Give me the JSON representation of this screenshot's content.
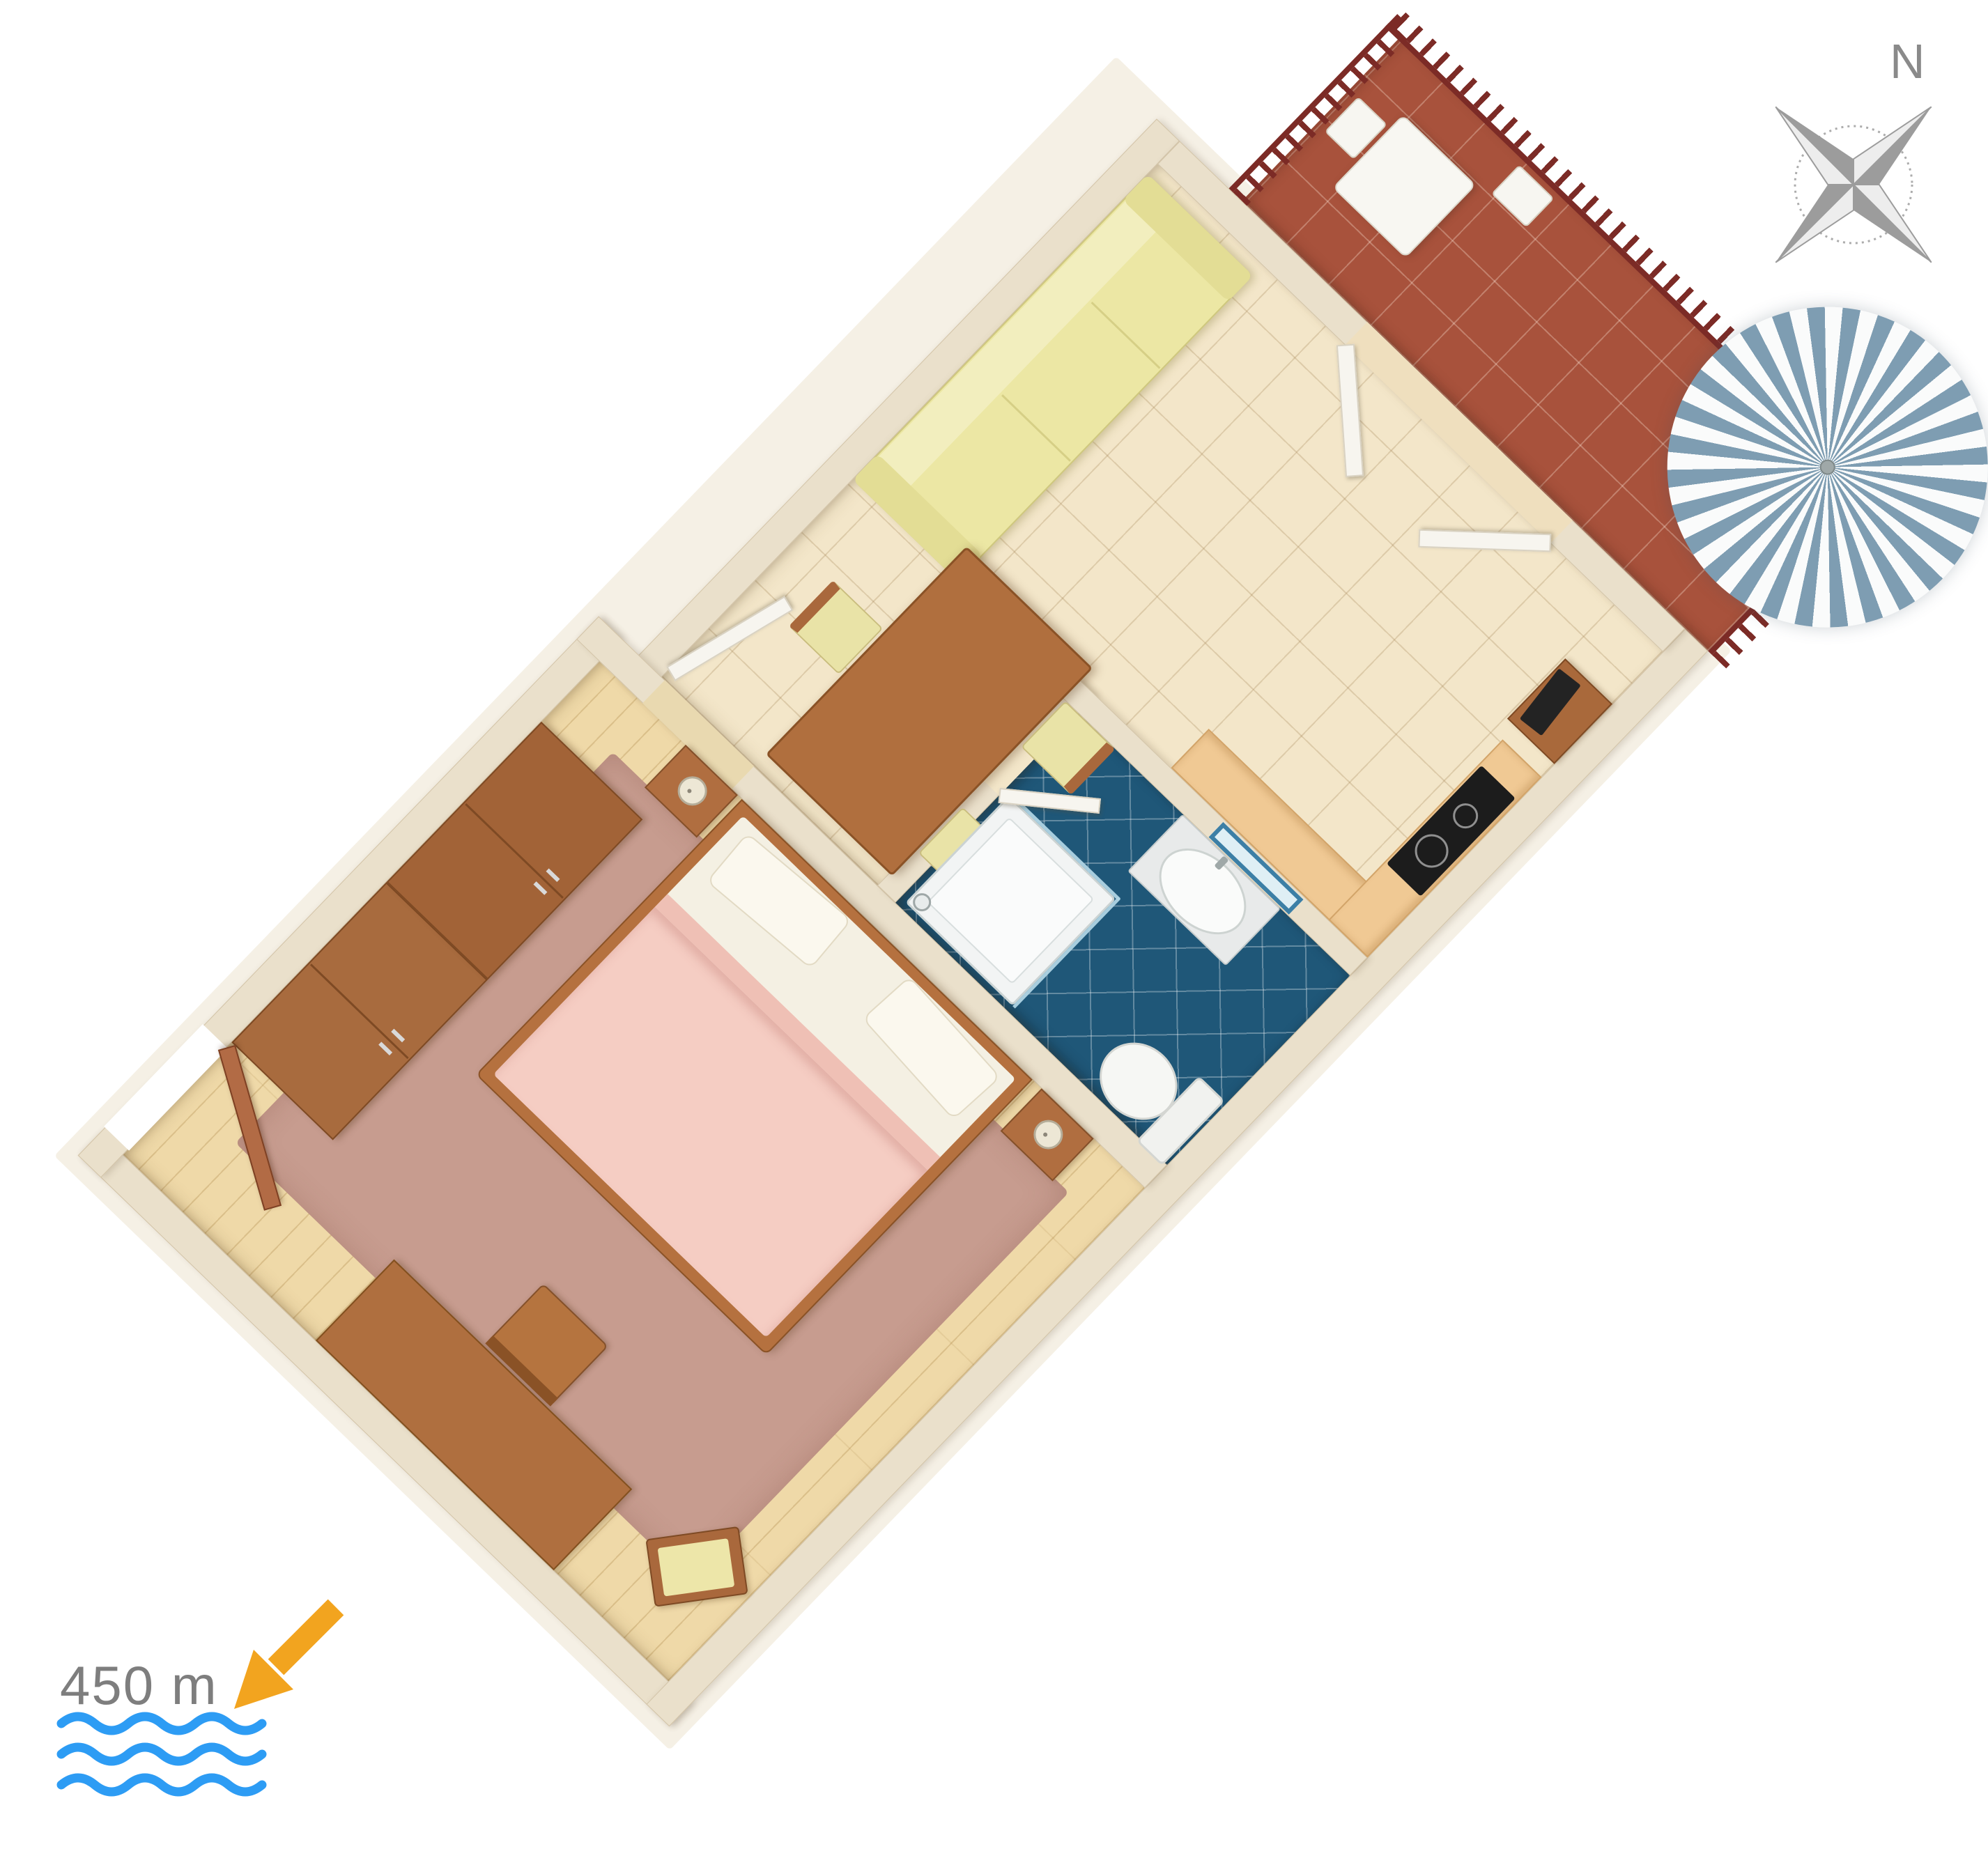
{
  "annotations": {
    "north_label": "N",
    "distance_label": "450 m"
  },
  "legend": {
    "distance_to_sea_m": 450,
    "direction_icon": "arrow-down-left",
    "sea_icon": "three-wavy-lines",
    "compass_icon": "four-point-compass-rose-rotated-45"
  },
  "colors": {
    "background": "#FFFFFF",
    "wall": "#EAE0CB",
    "bedroom_floor": "#EFD9A8",
    "bedroom_rug": "#C79C8F",
    "living_tile": "#F3E6C9",
    "bathroom_tile": "#1F5778",
    "terrace_tile": "#A8523C",
    "railing": "#7C2B26",
    "sofa": "#ECE7A4",
    "wood_furniture": "#AF6F3F",
    "bed_blanket": "#F5CDC3",
    "kitchen_counter": "#F0C994",
    "cooktop": "#1C1C1C",
    "parasol_stripe": "#7E9DB2",
    "arrow_orange": "#F2A41F",
    "waves_blue": "#2D9CF4",
    "label_gray": "#7E7E7E",
    "compass_gray": "#9C9C9C"
  },
  "floorplan": {
    "type": "3d-top-view-apartment",
    "rotation_deg": -46,
    "rooms": [
      {
        "name": "bedroom",
        "floor": "light wood planks with rose rug",
        "furniture": [
          "entry-door",
          "wardrobe-left",
          "wardrobe-right",
          "double-bed",
          "pillows",
          "nightstand-north",
          "nightstand-south",
          "table-lamps",
          "desk",
          "desk-chair",
          "corner-bench"
        ]
      },
      {
        "name": "living-dining",
        "floor": "beige ceramic tiles",
        "furniture": [
          "sofa",
          "dining-table",
          "dining-chairs-x3",
          "interior-door",
          "tv-stand",
          "tv"
        ]
      },
      {
        "name": "kitchen",
        "floor": "beige ceramic tiles",
        "furniture": [
          "l-shaped-counter",
          "cooktop"
        ]
      },
      {
        "name": "bathroom",
        "floor": "dark blue diagonal tiles",
        "furniture": [
          "shower",
          "washbasin",
          "mirror",
          "toilet",
          "bathroom-door"
        ]
      },
      {
        "name": "terrace",
        "floor": "terracotta tiles",
        "furniture": [
          "railing",
          "terrace-table",
          "terrace-chairs-x2",
          "parasol",
          "terrace-double-doors"
        ]
      }
    ]
  }
}
